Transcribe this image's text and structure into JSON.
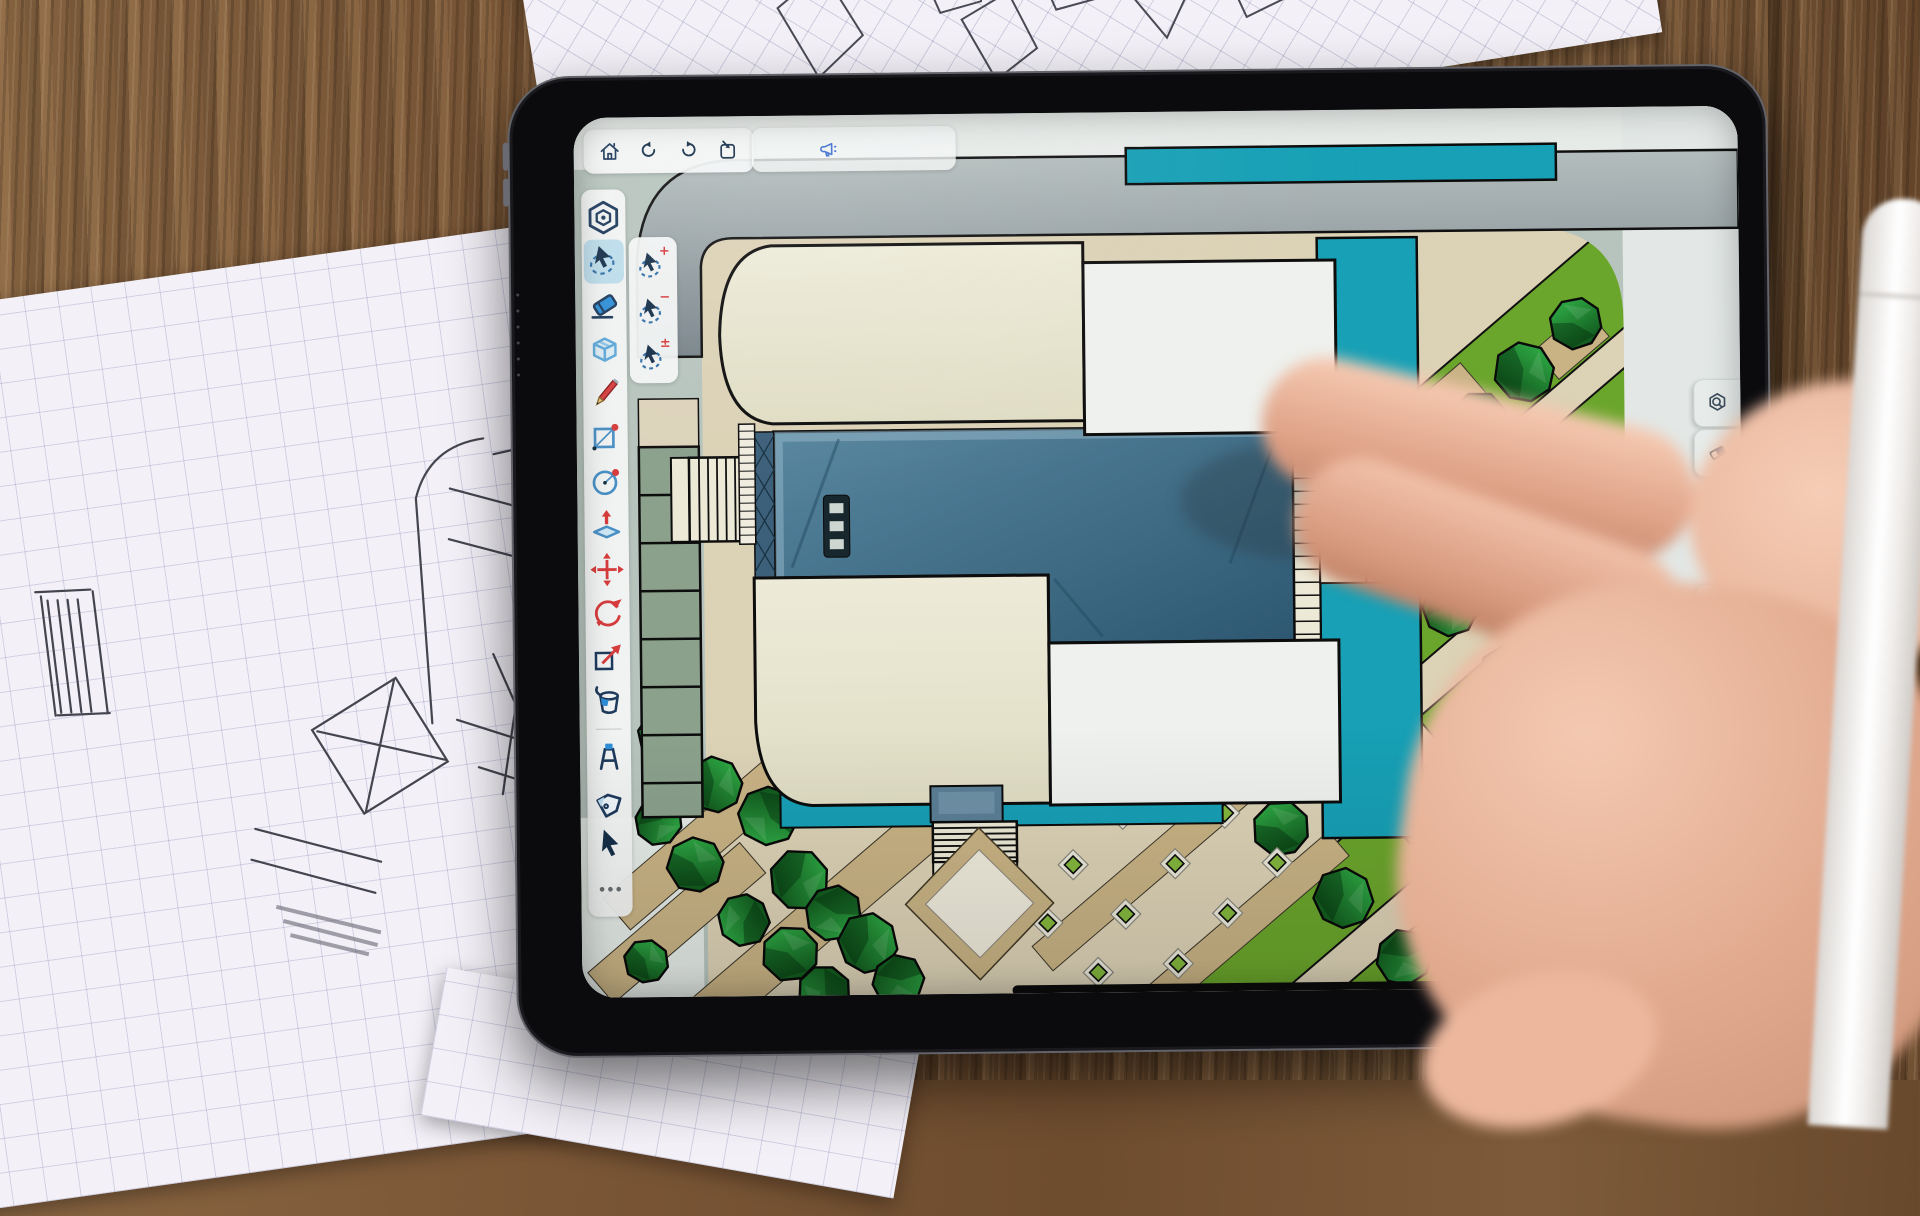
{
  "device": {
    "type": "tablet",
    "orientation": "landscape"
  },
  "app": {
    "top_toolbar": {
      "buttons": [
        {
          "id": "home",
          "label": "Home"
        },
        {
          "id": "undo",
          "label": "Undo"
        },
        {
          "id": "redo",
          "label": "Redo"
        },
        {
          "id": "export",
          "label": "Export"
        }
      ],
      "announce": {
        "id": "whats-new",
        "label": "Announcements"
      }
    },
    "tool_rail": {
      "tools": [
        {
          "id": "app-menu",
          "label": "App Menu"
        },
        {
          "id": "select",
          "label": "Select",
          "selected": true
        },
        {
          "id": "eraser",
          "label": "Eraser"
        },
        {
          "id": "box",
          "label": "3D Box"
        },
        {
          "id": "pencil",
          "label": "Draw"
        },
        {
          "id": "rectangle",
          "label": "Rectangle"
        },
        {
          "id": "circle",
          "label": "Circle"
        },
        {
          "id": "push-pull",
          "label": "Push/Pull"
        },
        {
          "id": "move",
          "label": "Move"
        },
        {
          "id": "rotate",
          "label": "Rotate"
        },
        {
          "id": "scale",
          "label": "Scale"
        },
        {
          "id": "paint",
          "label": "Paint"
        },
        {
          "id": "tape-measure",
          "label": "Tape Measure"
        },
        {
          "id": "tag",
          "label": "Tag"
        },
        {
          "id": "cursor",
          "label": "Cursor"
        },
        {
          "id": "more",
          "label": "More"
        }
      ]
    },
    "select_flyout": {
      "options": [
        {
          "id": "select-add",
          "label": "Select Add",
          "badge": "+"
        },
        {
          "id": "select-subtract",
          "label": "Select Subtract",
          "badge": "−"
        },
        {
          "id": "select-toggle",
          "label": "Select Toggle",
          "badge": "±"
        }
      ]
    },
    "right_panels": {
      "tabs": [
        {
          "id": "inspect",
          "label": "Inspect Model"
        },
        {
          "id": "styles",
          "label": "Styles"
        },
        {
          "id": "display",
          "label": "Display"
        },
        {
          "id": "settings",
          "label": "Settings"
        },
        {
          "id": "components",
          "label": "Components"
        }
      ]
    }
  },
  "canvas": {
    "view": "Top-down architectural site plan with buildings, glass courtyard, pools, plaza and trees"
  },
  "environment": {
    "objects": [
      "wood desk",
      "graph-paper sketches",
      "hand",
      "stylus"
    ]
  },
  "colors": {
    "wood": "#7a5636",
    "paper": "#f3f1f7",
    "bezel": "#0b0b0e",
    "screen_ui": "#f2f5f4",
    "accent_select": "#bcdcea",
    "icon_navy": "#1e3a5c",
    "icon_red": "#d63c3c",
    "icon_blue": "#2f8fd8",
    "announce_blue": "#3f6fd0",
    "canvas_sage": "#b7c4bd",
    "ground_beige": "#dcd2b6",
    "road_gray": "#8b969a",
    "water_teal": "#17a0b6",
    "glass_slate": "#3a637d",
    "building_cream": "#e9e7d1",
    "building_white": "#eef1ee",
    "lawn_green": "#6ba62c",
    "tree_green": "#1f8a30",
    "path_tan": "#c9b385"
  }
}
